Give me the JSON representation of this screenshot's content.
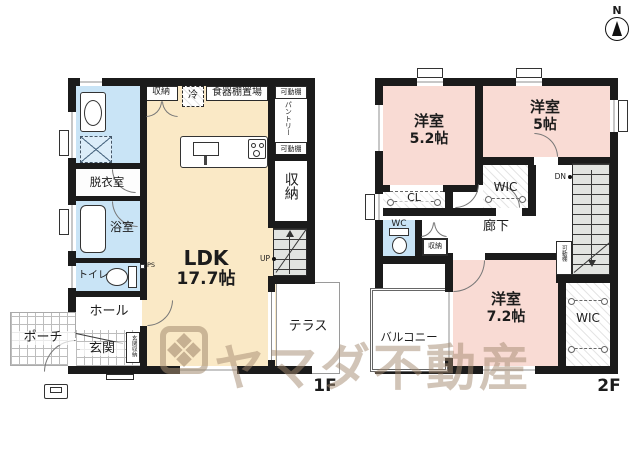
{
  "compass": {
    "north": "N"
  },
  "watermark": {
    "text": "ヤマダ不動産"
  },
  "floor1": {
    "label": "1F",
    "ldk": {
      "name": "LDK",
      "size": "17.7帖"
    },
    "closet_top": "収納",
    "fridge": "冷",
    "dish_shelf": "食器棚置場",
    "movable_shelf_top": "可動棚",
    "pantry": "パントリー",
    "movable_shelf_mid": "可動棚",
    "closet_right": "収納",
    "up": "UP",
    "ps": "PS",
    "dressing_room": "脱衣室",
    "bathroom": "浴室",
    "toilet": "トイレ",
    "hall": "ホール",
    "entrance": "玄関",
    "entrance_storage": "玄関収納",
    "porch": "ポーチ",
    "terrace": "テラス"
  },
  "floor2": {
    "label": "2F",
    "bedroom1": {
      "name": "洋室",
      "size": "5.2帖"
    },
    "bedroom2": {
      "name": "洋室",
      "size": "5帖"
    },
    "bedroom3": {
      "name": "洋室",
      "size": "7.2帖"
    },
    "wic_top": "WIC",
    "wic_bottom": "WIC",
    "cl": "CL",
    "wc": "WC",
    "storage": "収納",
    "corridor": "廊下",
    "dn": "DN",
    "movable_shelf": "可動棚",
    "balcony": "バルコニー"
  },
  "colors": {
    "wall": "#1b1b1b",
    "ldk": "#fae9c6",
    "wet": "#c9e4f6",
    "bedroom": "#f9dbd4",
    "stairs": "#e2e4e1",
    "watermark": "#a38a70"
  }
}
